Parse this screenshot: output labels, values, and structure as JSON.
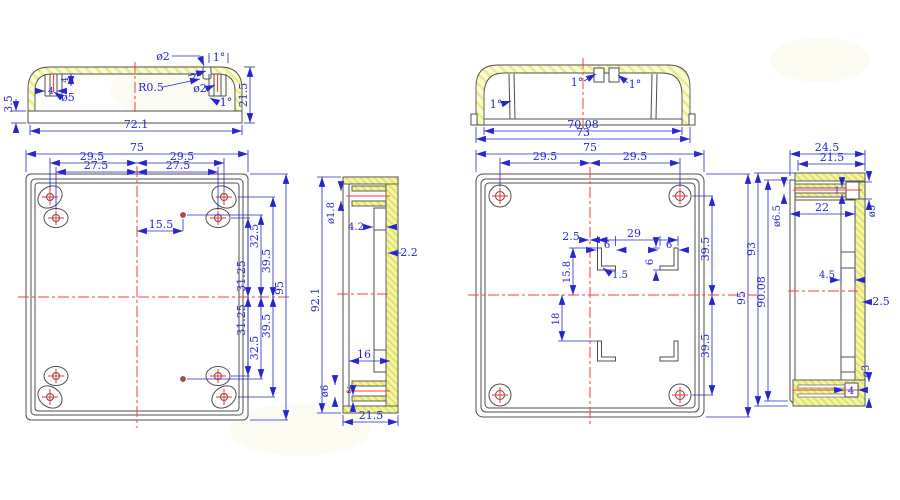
{
  "drawing_title": "Plastic enclosure engineering drawing",
  "colors": {
    "dimension_blue": "#2626cf",
    "outline_gray": "#4f4f4f",
    "hatch_yellow": "#eeee8e",
    "centerline_red": "#fa3c3c",
    "background": "#ffffff"
  },
  "views": {
    "lid_section": {
      "label": "lid cross-section",
      "dims": {
        "flange_h": "3.5",
        "width": "72.1",
        "height": "21.5",
        "boss_dia": "ø5",
        "boss_depth": "4",
        "hole_w": "4",
        "top_hole": "ø2",
        "radius": "R0.5",
        "draft_top": "2°",
        "side_hole": "ø2",
        "draft1": "1°",
        "draft2": "1°"
      }
    },
    "base_section": {
      "label": "base cross-section",
      "dims": {
        "draft_wall": "1°",
        "draft_clip_l": "1°",
        "draft_clip_r": "1°",
        "inner_w": "70.08",
        "outer_w": "73"
      }
    },
    "lid_plan": {
      "label": "lid inside view",
      "dims": {
        "width": "75",
        "hole_l": "29.5",
        "hole_r": "29.5",
        "boss_l": "27.5",
        "boss_r": "27.5",
        "pin_offset": "15.5",
        "t1": "32.5",
        "t2": "31.25",
        "t3": "39.5",
        "height": "95",
        "b1": "31.25",
        "b2": "32.5",
        "b3": "39.5"
      }
    },
    "lid_side": {
      "label": "lid side section",
      "dims": {
        "height": "92.1",
        "pin_dia": "ø1.8",
        "tab": "4.2",
        "wall": "2.2",
        "slot": "16",
        "boss_dia": "ø6",
        "rib": "2",
        "depth": "21.5"
      }
    },
    "base_plan": {
      "label": "base inside view",
      "dims": {
        "width": "75",
        "hole_l": "29.5",
        "hole_r": "29.5",
        "clip_off": "2.5",
        "clip_w_l": "6",
        "clip_span": "29",
        "clip_w_r": "6",
        "clip_h": "6",
        "clip_y_top": "15.8",
        "clip_t": "1.5",
        "clip_y_bot": "18",
        "t1": "39.5",
        "height": "95",
        "b1": "39.5"
      }
    },
    "base_side": {
      "label": "base side section",
      "dims": {
        "depth": "24.5",
        "inner_depth": "21.5",
        "boss_hole": "ø6.5",
        "boss_len": "22",
        "boss_dia": "ø5",
        "rib_t": "1",
        "rail": "4.5",
        "wall": "2.5",
        "hole_bot": "ø3",
        "boss_w": "4",
        "height": "93",
        "inner_height": "90.08"
      }
    }
  }
}
